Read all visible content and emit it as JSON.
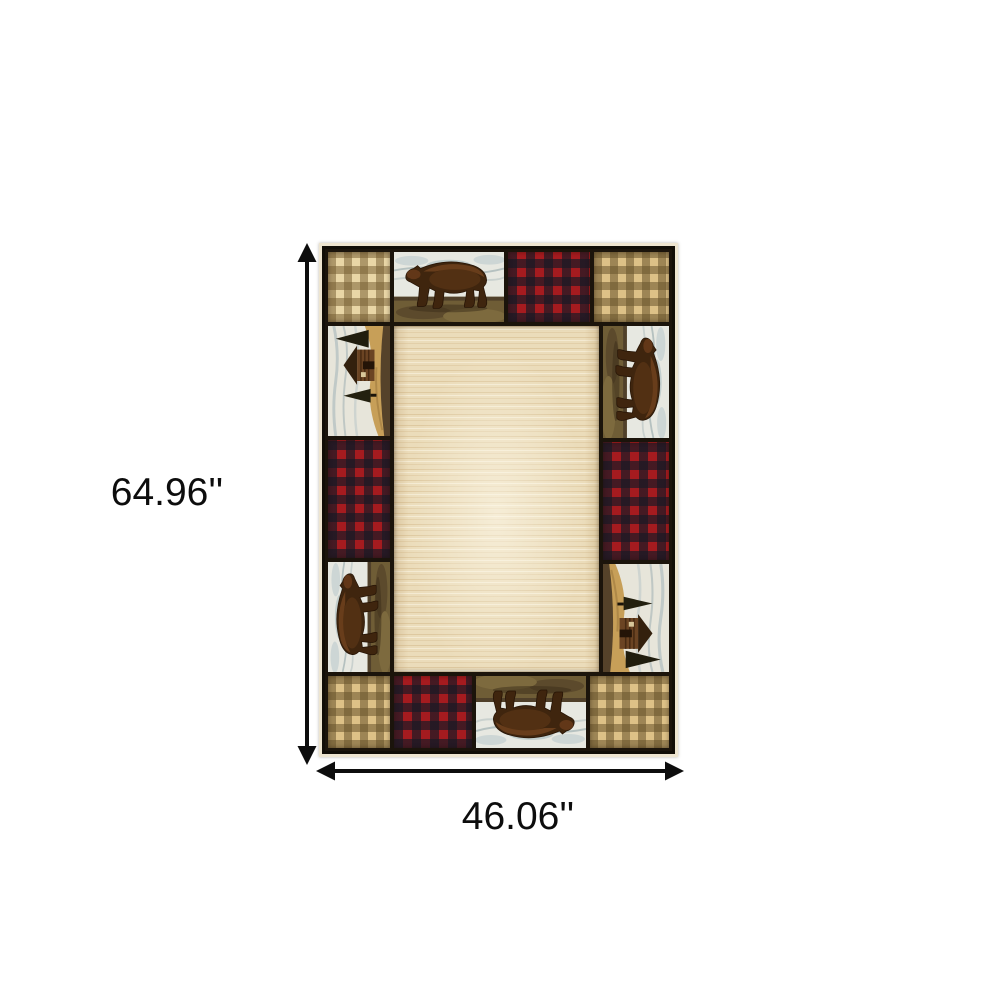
{
  "diagram": {
    "type": "product-dimension-diagram",
    "product": "Rustic lodge patchwork area rug with bears, log cabins, buffalo-check and gingham plaid patches around a plain beige field",
    "background_color": "#ffffff",
    "arrow_color": "#0d0d0d",
    "height_label": "64.96''",
    "width_label": "46.06''"
  },
  "rug": {
    "colors": {
      "grout": "#1b140b",
      "outer_border": "#120e07",
      "fringe": "#eee5d0",
      "field_base": "#ebdcba",
      "field_streak": "#c19c64",
      "plaid_tan_base": "#e9d6a6",
      "plaid_tan_check": "#765d31",
      "plaid_red_base": "#a51b1f",
      "plaid_red_check": "#171925",
      "bear_body": "#3f250e",
      "bear_highlight": "#8a5227",
      "scene_sky": "#e7e8e1",
      "scene_cloud": "#aebabb",
      "scene_ground": "#6f5d36",
      "cabin_wall": "#6b4423",
      "cabin_roof": "#33200d",
      "hillside": "#c79f58",
      "pine_tree": "#201d0e"
    },
    "patches": [
      {
        "position": "top-left",
        "type": "tan-plaid"
      },
      {
        "position": "top-center",
        "type": "walking-bear-scene"
      },
      {
        "position": "top-right-inner",
        "type": "red-buffalo-plaid"
      },
      {
        "position": "top-right",
        "type": "tan-plaid"
      },
      {
        "position": "left-upper",
        "type": "log-cabin-scene"
      },
      {
        "position": "left-middle",
        "type": "red-buffalo-plaid"
      },
      {
        "position": "left-lower",
        "type": "walking-bear-scene"
      },
      {
        "position": "right-upper",
        "type": "walking-bear-scene"
      },
      {
        "position": "right-middle",
        "type": "red-buffalo-plaid"
      },
      {
        "position": "right-lower",
        "type": "log-cabin-scene"
      },
      {
        "position": "bottom-left",
        "type": "tan-plaid"
      },
      {
        "position": "bottom-left-inner",
        "type": "red-buffalo-plaid"
      },
      {
        "position": "bottom-center",
        "type": "walking-bear-scene"
      },
      {
        "position": "bottom-right",
        "type": "tan-plaid"
      },
      {
        "position": "center",
        "type": "plain-beige-field"
      }
    ]
  }
}
